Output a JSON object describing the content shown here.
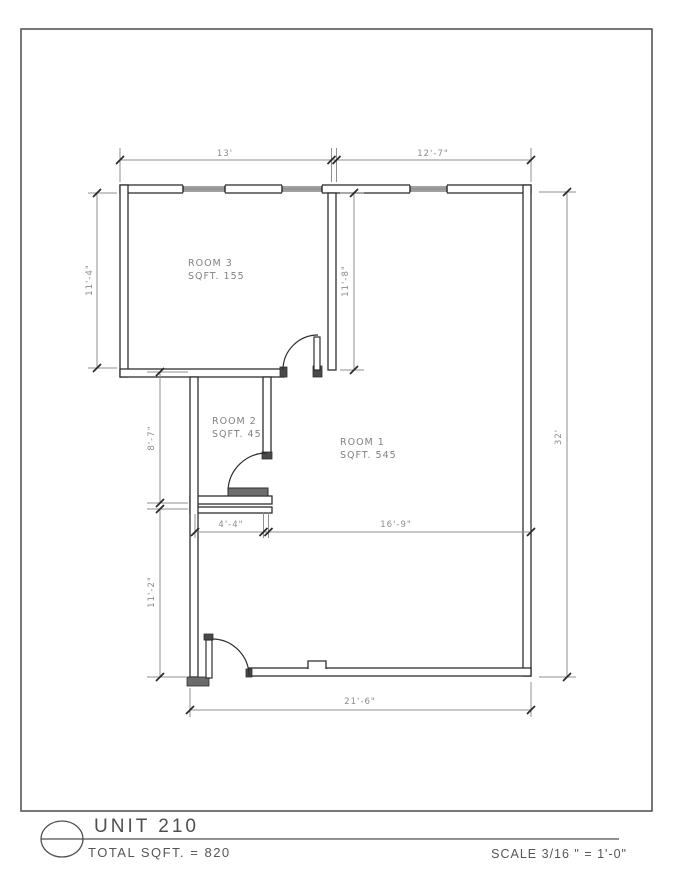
{
  "drawing": {
    "rooms": [
      {
        "name": "ROOM 3",
        "sqft_label": "SQFT. 155"
      },
      {
        "name": "ROOM 2",
        "sqft_label": "SQFT. 45"
      },
      {
        "name": "ROOM 1",
        "sqft_label": "SQFT. 545"
      }
    ],
    "dimensions": {
      "top_left_width": "13'",
      "top_right_width": "12'-7\"",
      "room3_height": "11'-4\"",
      "room1_upper_height": "11'-8\"",
      "room2_height": "8'-7\"",
      "lower_left_height": "11'-2\"",
      "right_height": "32'",
      "room2_width": "4'-4\"",
      "room1_width": "16'-9\"",
      "bottom_width": "21'-6\""
    }
  },
  "title_block": {
    "unit_label": "UNIT 210",
    "total_sqft_label": "TOTAL SQFT. = 820",
    "scale_label": "SCALE 3/16 \" = 1'-0\""
  }
}
